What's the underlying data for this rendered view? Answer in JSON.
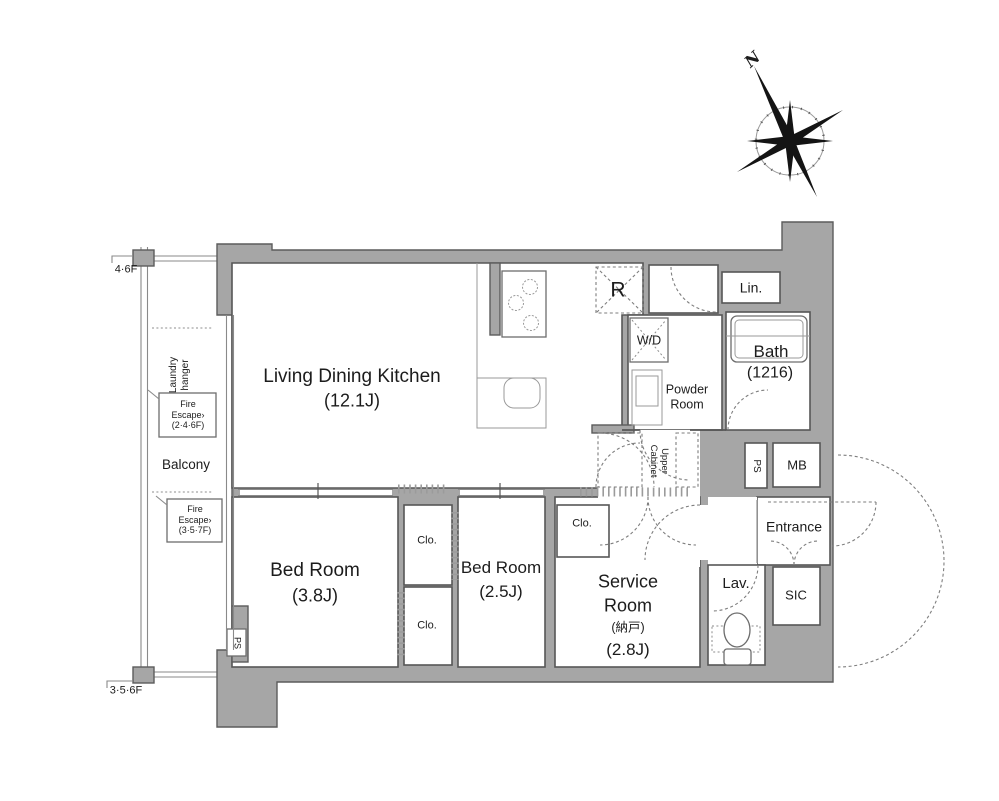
{
  "floor_indicators": {
    "upper": "4·6F",
    "lower": "3·5·6F"
  },
  "balcony": {
    "label": "Balcony",
    "laundry_hanger": "Laundry\nhanger",
    "fire_escape_upper": "Fire\nEscape›\n(2·4·6F)",
    "fire_escape_lower": "Fire\nEscape›\n(3·5·7F)"
  },
  "compass": {
    "north": "N"
  },
  "rooms": {
    "ldk": {
      "name": "Living Dining Kitchen",
      "size": "(12.1J)"
    },
    "bedroom_a": {
      "name": "Bed Room",
      "size": "(3.8J)"
    },
    "bedroom_b": {
      "name": "Bed Room",
      "size": "(2.5J)"
    },
    "service_room": {
      "line1": "Service",
      "line2": "Room",
      "sub": "(納戸)",
      "size": "(2.8J)"
    },
    "bath": {
      "name": "Bath",
      "size": "(1216)"
    },
    "powder_room": {
      "text": "Powder\nRoom"
    },
    "linen": {
      "label": "Lin."
    },
    "washer_dryer": {
      "label": "W/D"
    },
    "refrigerator": {
      "label": "R"
    },
    "meter_box": {
      "label": "MB"
    },
    "pipe_space_a": {
      "label": "PS"
    },
    "pipe_space_b": {
      "label": "PS"
    },
    "upper_cabinet": {
      "text": "Upper\nCabinet"
    },
    "entrance": {
      "label": "Entrance"
    },
    "lavatory": {
      "label": "Lav."
    },
    "sic": {
      "label": "SIC"
    },
    "closet_a": {
      "label": "Clo."
    },
    "closet_b": {
      "label": "Clo."
    },
    "closet_c": {
      "label": "Clo."
    }
  },
  "colors": {
    "wall_fill": "#a6a6a6",
    "wall_outline": "#5c5c5c",
    "line": "#565656",
    "background": "#ffffff"
  }
}
